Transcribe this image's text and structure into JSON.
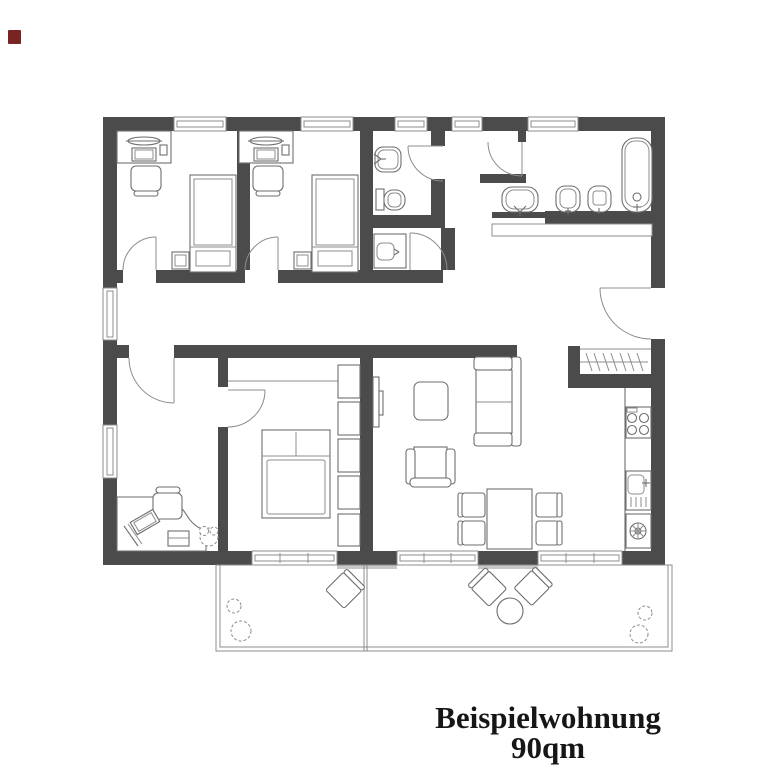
{
  "title": {
    "line1": "Beispielwohnung",
    "line2": "90qm"
  },
  "colors": {
    "wall": "#4b4b4b",
    "line": "#6e6e6e",
    "line2": "#8c8c8c",
    "frame": "#8c8c8c",
    "threshold": "#c9c9c9",
    "text": "#161616",
    "mark": "#7a2323"
  },
  "rooms": [
    "bedroom-1",
    "bedroom-2",
    "wc",
    "bathroom",
    "corridor",
    "entrance-hall",
    "office",
    "master-bedroom",
    "living-room",
    "kitchen",
    "terrace"
  ],
  "symbols": [
    "single-bed",
    "double-bed",
    "desk",
    "desk-lamp",
    "laptop",
    "office-chair",
    "nightstand",
    "wardrobe",
    "coat-closet",
    "washbasin",
    "toilet",
    "bidet",
    "bathtub",
    "utility-sink",
    "kitchen-stove",
    "kitchen-sink",
    "washing-machine",
    "tv",
    "sofa",
    "armchair",
    "coffee-table",
    "dining-table",
    "dining-chair",
    "terrace-chair",
    "terrace-table",
    "plant",
    "door-swing",
    "window"
  ]
}
